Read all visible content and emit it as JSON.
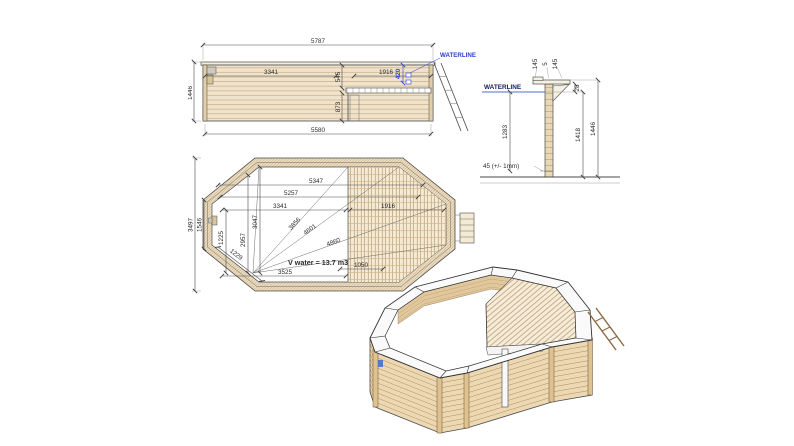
{
  "colors": {
    "dimension": "#3a3a3a",
    "waterline_blue": "#2b3fd0",
    "wood_light": "#efe3cc",
    "wood_line": "#c9ad83"
  },
  "elevation": {
    "waterline_label": "WATERLINE",
    "overall_width": "5787",
    "base_width": "5580",
    "height": "1446",
    "left_section": "3341",
    "right_section": "1916",
    "upper_inner_height": "545",
    "lower_inner_height": "873",
    "waterline_depth": "420"
  },
  "section": {
    "waterline_label": "WATERLINE",
    "cap_front": "145",
    "cap_gap": "5",
    "cap_back": "145",
    "top_to_waterline": "28",
    "water_depth": "1283",
    "wall_height": "1418",
    "total_height": "1446",
    "base_note": "45 (+/- 1mm)"
  },
  "plan": {
    "inner_length_1": "5347",
    "inner_length_2": "5257",
    "left_span": "3341",
    "deck_span": "1916",
    "overall_width": "3497",
    "side_width": "1546",
    "left_offset": "1225",
    "corner_span": "1229",
    "inner_width_1": "2957",
    "inner_width_2": "3047",
    "diag_1": "3856",
    "diag_2": "4601",
    "diag_3": "4860",
    "bottom_span": "3525",
    "deck_depth": "1050",
    "volume_label": "V water = 13.7 m3"
  }
}
